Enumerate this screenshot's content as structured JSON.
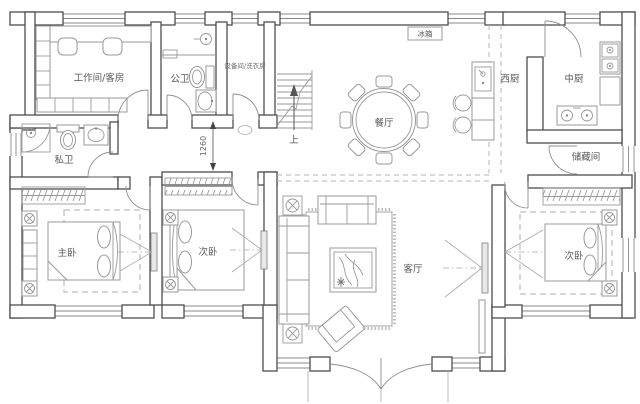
{
  "plan": {
    "title": "single-storey house floor plan",
    "labels": {
      "workroom": "工作间/客房",
      "public_bath": "公卫",
      "equipment_laundry": "设备间/洗衣房",
      "fridge": "冰箱",
      "dining_room": "餐厅",
      "west_kitchen": "西厨",
      "chinese_kitchen": "中厨",
      "storage": "储藏间",
      "private_bath": "私卫",
      "master_bedroom": "主卧",
      "bedroom_middle": "次卧",
      "bedroom_right": "次卧",
      "living_room": "客厅"
    },
    "annotations": {
      "stairs_up": "上",
      "dimension_1260": "1260"
    },
    "colors": {
      "background": "#ffffff",
      "wall_outline": "#4d4d4d",
      "furniture_line": "#9a9a9a",
      "label_text": "#5a5a5a"
    }
  }
}
